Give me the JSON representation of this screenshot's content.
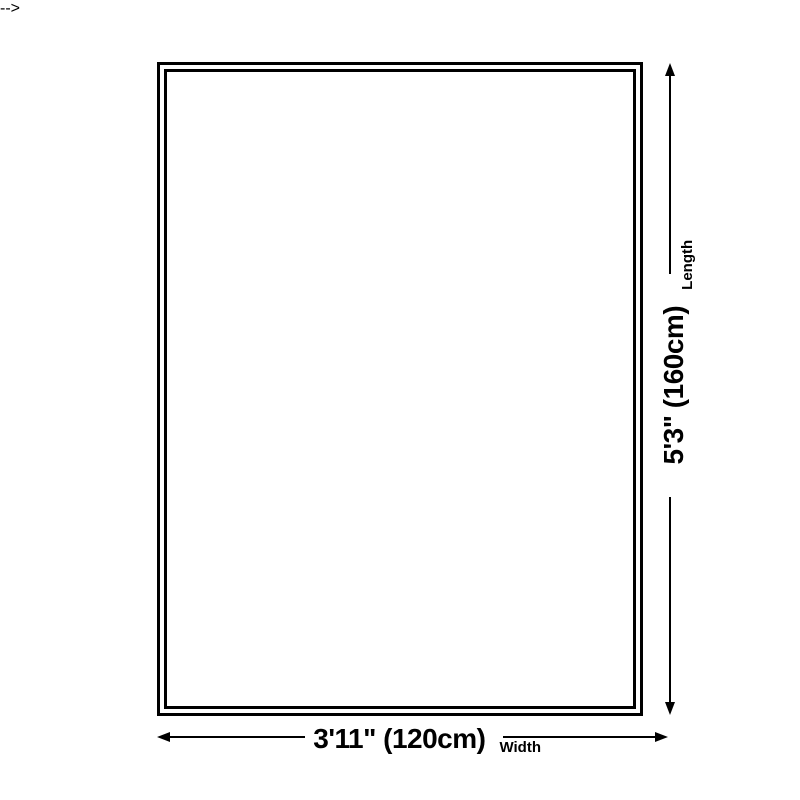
{
  "diagram": {
    "background_color": "#ffffff",
    "line_color": "#000000",
    "width_dimension": {
      "value_label": "3'11\" (120cm)",
      "axis_label": "Width"
    },
    "length_dimension": {
      "value_label": "5'3\" (160cm)",
      "axis_label": "Length"
    },
    "icons": {
      "arrow_left": "css-triangle-left",
      "arrow_right": "css-triangle-right",
      "arrow_up": "css-triangle-up",
      "arrow_down": "css-triangle-down"
    }
  }
}
